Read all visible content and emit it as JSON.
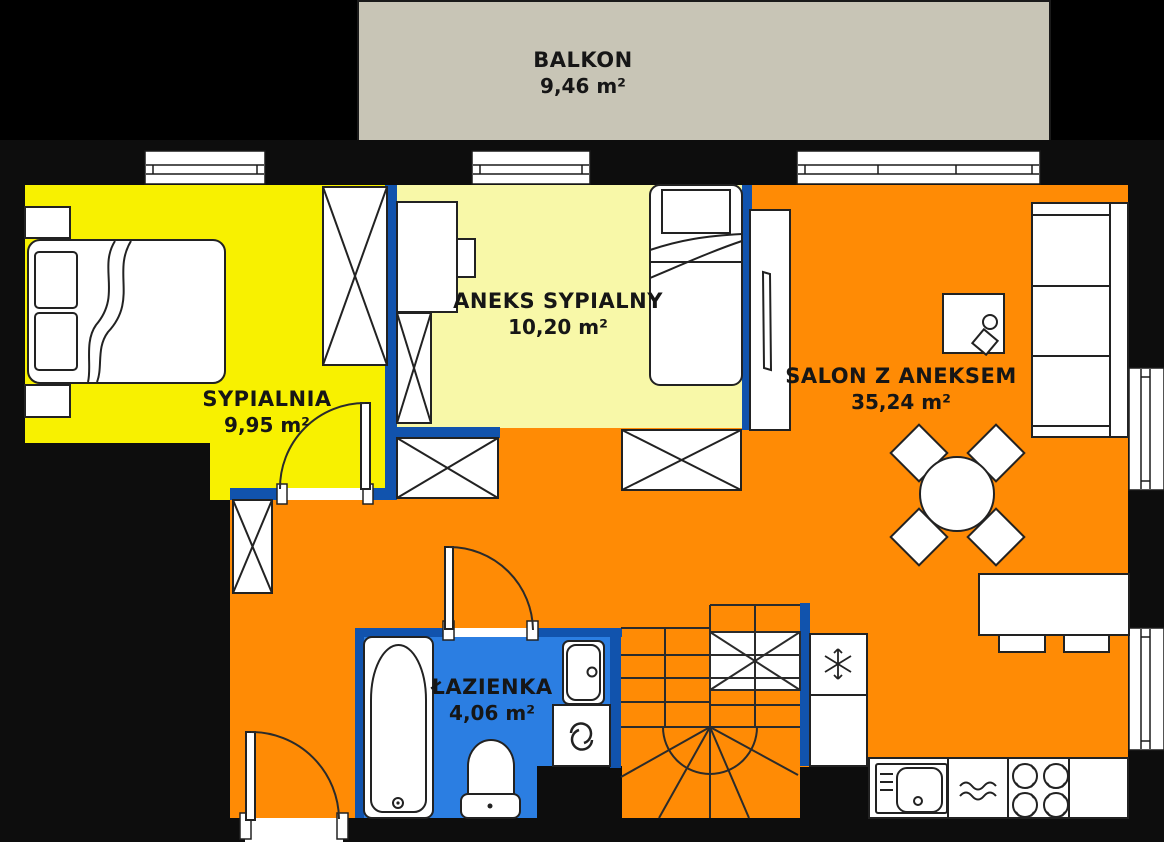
{
  "plan_title": "apartment-floor-plan",
  "rooms": {
    "balkon": {
      "name": "BALKON",
      "area": "9,46 m²"
    },
    "sypialnia": {
      "name": "SYPIALNIA",
      "area": "9,95 m²"
    },
    "aneks": {
      "name": "ANEKS SYPIALNY",
      "area": "10,20 m²"
    },
    "salon": {
      "name": "SALON Z ANEKSEM",
      "area": "35,24 m²"
    },
    "lazienka": {
      "name": "ŁAZIENKA",
      "area": "4,06 m²"
    }
  },
  "colors": {
    "salon_floor": "#FF8B05",
    "sypialnia_floor": "#F8F100",
    "aneks_floor": "#F8F8A8",
    "lazienka_floor": "#2B7EE2",
    "partition_wall": "#1153AD",
    "exterior_wall": "#0D0D0D",
    "balkon_floor": "#C8C5B6",
    "furniture_fill": "#FFFFFF",
    "outline": "#222222"
  },
  "icons": {
    "fridge": "snowflake-icon",
    "washing_machine": "swirl-icon",
    "cooktop": "burner-rings-icon",
    "heater": "waves-icon"
  }
}
